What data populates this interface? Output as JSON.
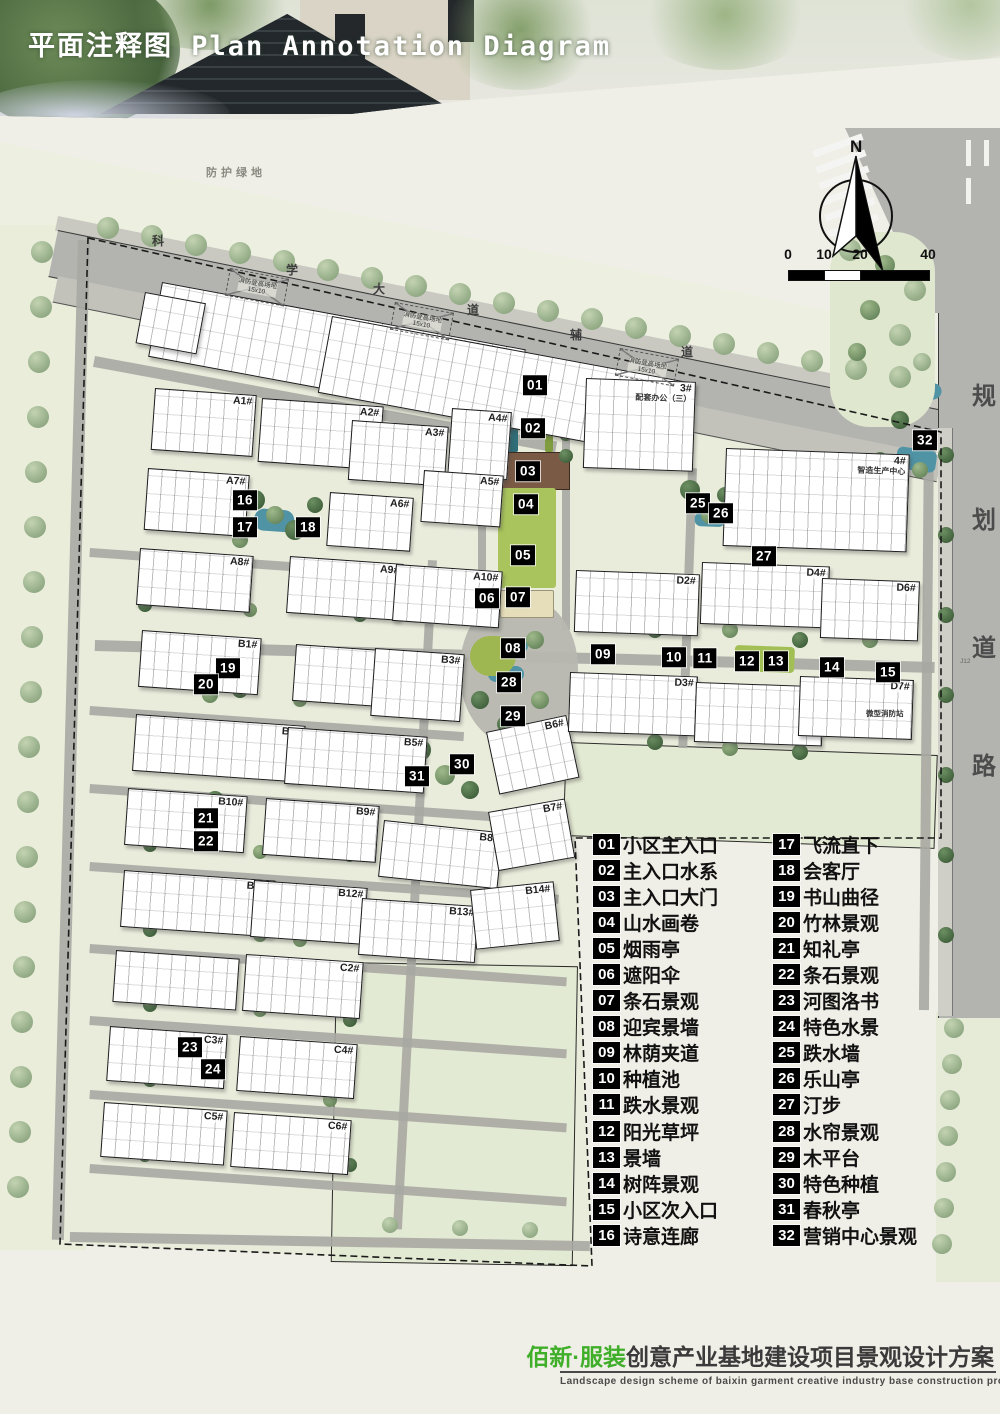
{
  "header": {
    "title": "平面注释图 Plan Annotation Diagram"
  },
  "north": {
    "label": "N"
  },
  "scale_bar": {
    "labels": [
      "0",
      "10",
      "20",
      "40"
    ]
  },
  "map_labels": {
    "protective_green": "防护绿地",
    "street_chars": [
      "科",
      "学",
      "大",
      "道",
      "辅",
      "道"
    ],
    "planned_road_chars": [
      "规",
      "划",
      "道",
      "路"
    ],
    "fire_pad_line1": "消防登高场地",
    "fire_pad_line2": "15x10",
    "micro_fire_station": "微型消防站",
    "road_code": "J12"
  },
  "colors": {
    "brand_green": "#3fae29",
    "marker_bg": "#000000",
    "road_gray": "#b3b3af",
    "site_green": "#e9ecdb",
    "water_teal": "#4f93a5",
    "lawn_green": "#a9c45c"
  },
  "buildings": [
    {
      "label": "1#",
      "sub": "配套办公",
      "x": 162,
      "y": 282,
      "w": 368,
      "h": 74,
      "rot": 10.5
    },
    {
      "label": "2#",
      "sub": "配套办公",
      "x": 332,
      "y": 316,
      "w": 368,
      "h": 76,
      "rot": 10.5
    },
    {
      "label": "3#",
      "sub": "配套办公（三）",
      "x": 586,
      "y": 378,
      "w": 108,
      "h": 88,
      "rot": 2
    },
    {
      "label": "4#",
      "sub": "智造生产中心",
      "x": 726,
      "y": 448,
      "w": 182,
      "h": 96,
      "rot": 2
    },
    {
      "label": "A1#",
      "x": 155,
      "y": 388,
      "w": 100,
      "h": 60,
      "rot": 4
    },
    {
      "label": "A2#",
      "x": 262,
      "y": 398,
      "w": 120,
      "h": 62,
      "rot": 4
    },
    {
      "label": "A3#",
      "x": 352,
      "y": 420,
      "w": 95,
      "h": 58,
      "rot": 4
    },
    {
      "label": "A4#",
      "x": 452,
      "y": 408,
      "w": 58,
      "h": 66,
      "rot": 4
    },
    {
      "label": "A5#",
      "x": 424,
      "y": 470,
      "w": 78,
      "h": 50,
      "rot": 4
    },
    {
      "label": "A6#",
      "x": 330,
      "y": 492,
      "w": 82,
      "h": 52,
      "rot": 4
    },
    {
      "label": "A7#",
      "x": 148,
      "y": 468,
      "w": 100,
      "h": 60,
      "rot": 4
    },
    {
      "label": "A8#",
      "x": 140,
      "y": 548,
      "w": 112,
      "h": 55,
      "rot": 4
    },
    {
      "label": "A9#",
      "x": 290,
      "y": 556,
      "w": 112,
      "h": 55,
      "rot": 4
    },
    {
      "label": "A10#",
      "x": 396,
      "y": 564,
      "w": 105,
      "h": 55,
      "rot": 4
    },
    {
      "label": "B1#",
      "x": 142,
      "y": 630,
      "w": 118,
      "h": 55,
      "rot": 4
    },
    {
      "label": "B2#",
      "x": 296,
      "y": 644,
      "w": 108,
      "h": 55,
      "rot": 4
    },
    {
      "label": "B3#",
      "x": 375,
      "y": 648,
      "w": 88,
      "h": 66,
      "rot": 4
    },
    {
      "label": "B4#",
      "x": 136,
      "y": 714,
      "w": 168,
      "h": 55,
      "rot": 4
    },
    {
      "label": "B5#",
      "x": 288,
      "y": 727,
      "w": 138,
      "h": 55,
      "rot": 4
    },
    {
      "label": "B6#",
      "x": 486,
      "y": 732,
      "w": 80,
      "h": 62,
      "rot": -12
    },
    {
      "label": "B10#",
      "x": 128,
      "y": 788,
      "w": 118,
      "h": 55,
      "rot": 4
    },
    {
      "label": "B9#",
      "x": 266,
      "y": 798,
      "w": 112,
      "h": 55,
      "rot": 4
    },
    {
      "label": "B8#",
      "x": 384,
      "y": 820,
      "w": 118,
      "h": 55,
      "rot": 6
    },
    {
      "label": "B7#",
      "x": 488,
      "y": 812,
      "w": 76,
      "h": 58,
      "rot": -10
    },
    {
      "label": "B11#",
      "x": 124,
      "y": 870,
      "w": 150,
      "h": 55,
      "rot": 4
    },
    {
      "label": "B12#",
      "x": 254,
      "y": 880,
      "w": 112,
      "h": 55,
      "rot": 4
    },
    {
      "label": "B13#",
      "x": 362,
      "y": 898,
      "w": 115,
      "h": 55,
      "rot": 4
    },
    {
      "label": "B14#",
      "x": 470,
      "y": 890,
      "w": 82,
      "h": 58,
      "rot": -6
    },
    {
      "label": "",
      "x": 116,
      "y": 950,
      "w": 122,
      "h": 50,
      "rot": 4
    },
    {
      "label": "C2#",
      "x": 246,
      "y": 954,
      "w": 116,
      "h": 55,
      "rot": 4
    },
    {
      "label": "C3#",
      "x": 110,
      "y": 1026,
      "w": 116,
      "h": 53,
      "rot": 4
    },
    {
      "label": "C4#",
      "x": 240,
      "y": 1036,
      "w": 116,
      "h": 53,
      "rot": 4
    },
    {
      "label": "C5#",
      "x": 104,
      "y": 1102,
      "w": 122,
      "h": 53,
      "rot": 4
    },
    {
      "label": "C6#",
      "x": 234,
      "y": 1112,
      "w": 116,
      "h": 53,
      "rot": 4
    },
    {
      "label": "D2#",
      "x": 576,
      "y": 570,
      "w": 122,
      "h": 60,
      "rot": 2
    },
    {
      "label": "D4#",
      "x": 702,
      "y": 562,
      "w": 126,
      "h": 60,
      "rot": 2
    },
    {
      "label": "D6#",
      "x": 822,
      "y": 578,
      "w": 96,
      "h": 58,
      "rot": 2
    },
    {
      "label": "D3#",
      "x": 570,
      "y": 672,
      "w": 126,
      "h": 58,
      "rot": 2
    },
    {
      "label": "D5#",
      "x": 696,
      "y": 682,
      "w": 126,
      "h": 58,
      "rot": 2
    },
    {
      "label": "D7#",
      "x": 800,
      "y": 676,
      "w": 112,
      "h": 58,
      "rot": 2
    },
    {
      "label": "",
      "x": 145,
      "y": 292,
      "w": 60,
      "h": 50,
      "rot": 10.5
    }
  ],
  "markers": [
    {
      "n": "01",
      "x": 535,
      "y": 385
    },
    {
      "n": "02",
      "x": 533,
      "y": 428
    },
    {
      "n": "03",
      "x": 528,
      "y": 471
    },
    {
      "n": "04",
      "x": 526,
      "y": 504
    },
    {
      "n": "05",
      "x": 523,
      "y": 555
    },
    {
      "n": "06",
      "x": 487,
      "y": 598
    },
    {
      "n": "07",
      "x": 518,
      "y": 597
    },
    {
      "n": "08",
      "x": 513,
      "y": 648
    },
    {
      "n": "09",
      "x": 603,
      "y": 654
    },
    {
      "n": "10",
      "x": 674,
      "y": 657
    },
    {
      "n": "11",
      "x": 705,
      "y": 658
    },
    {
      "n": "12",
      "x": 747,
      "y": 661
    },
    {
      "n": "13",
      "x": 776,
      "y": 661
    },
    {
      "n": "14",
      "x": 832,
      "y": 667
    },
    {
      "n": "15",
      "x": 888,
      "y": 672
    },
    {
      "n": "16",
      "x": 245,
      "y": 500
    },
    {
      "n": "17",
      "x": 245,
      "y": 527
    },
    {
      "n": "18",
      "x": 308,
      "y": 527
    },
    {
      "n": "19",
      "x": 228,
      "y": 668
    },
    {
      "n": "20",
      "x": 206,
      "y": 684
    },
    {
      "n": "21",
      "x": 206,
      "y": 818
    },
    {
      "n": "22",
      "x": 206,
      "y": 841
    },
    {
      "n": "23",
      "x": 190,
      "y": 1047
    },
    {
      "n": "24",
      "x": 213,
      "y": 1069
    },
    {
      "n": "25",
      "x": 698,
      "y": 503
    },
    {
      "n": "26",
      "x": 721,
      "y": 513
    },
    {
      "n": "27",
      "x": 764,
      "y": 556
    },
    {
      "n": "28",
      "x": 509,
      "y": 682
    },
    {
      "n": "29",
      "x": 513,
      "y": 716
    },
    {
      "n": "30",
      "x": 462,
      "y": 764
    },
    {
      "n": "31",
      "x": 417,
      "y": 776
    },
    {
      "n": "32",
      "x": 925,
      "y": 440
    }
  ],
  "legend": {
    "items": [
      {
        "num": "01",
        "label": "小区主入口"
      },
      {
        "num": "02",
        "label": "主入口水系"
      },
      {
        "num": "03",
        "label": "主入口大门"
      },
      {
        "num": "04",
        "label": "山水画卷"
      },
      {
        "num": "05",
        "label": "烟雨亭"
      },
      {
        "num": "06",
        "label": "遮阳伞"
      },
      {
        "num": "07",
        "label": "条石景观"
      },
      {
        "num": "08",
        "label": "迎宾景墙"
      },
      {
        "num": "09",
        "label": "林荫夹道"
      },
      {
        "num": "10",
        "label": "种植池"
      },
      {
        "num": "11",
        "label": "跌水景观"
      },
      {
        "num": "12",
        "label": "阳光草坪"
      },
      {
        "num": "13",
        "label": "景墙"
      },
      {
        "num": "14",
        "label": "树阵景观"
      },
      {
        "num": "15",
        "label": "小区次入口"
      },
      {
        "num": "16",
        "label": "诗意连廊"
      },
      {
        "num": "17",
        "label": "飞流直下"
      },
      {
        "num": "18",
        "label": "会客厅"
      },
      {
        "num": "19",
        "label": "书山曲径"
      },
      {
        "num": "20",
        "label": "竹林景观"
      },
      {
        "num": "21",
        "label": "知礼亭"
      },
      {
        "num": "22",
        "label": "条石景观"
      },
      {
        "num": "23",
        "label": "河图洛书"
      },
      {
        "num": "24",
        "label": "特色水景"
      },
      {
        "num": "25",
        "label": "跌水墙"
      },
      {
        "num": "26",
        "label": "乐山亭"
      },
      {
        "num": "27",
        "label": "汀步"
      },
      {
        "num": "28",
        "label": "水帘景观"
      },
      {
        "num": "29",
        "label": "木平台"
      },
      {
        "num": "30",
        "label": "特色种植"
      },
      {
        "num": "31",
        "label": "春秋亭"
      },
      {
        "num": "32",
        "label": "营销中心景观"
      }
    ]
  },
  "footer": {
    "brand": "佰新·服装",
    "title": "创意产业基地建设项目景观设计方案",
    "subtitle_en": "Landscape  design  scheme  of  baixin  garment  creative  industry  base  construction  project"
  }
}
